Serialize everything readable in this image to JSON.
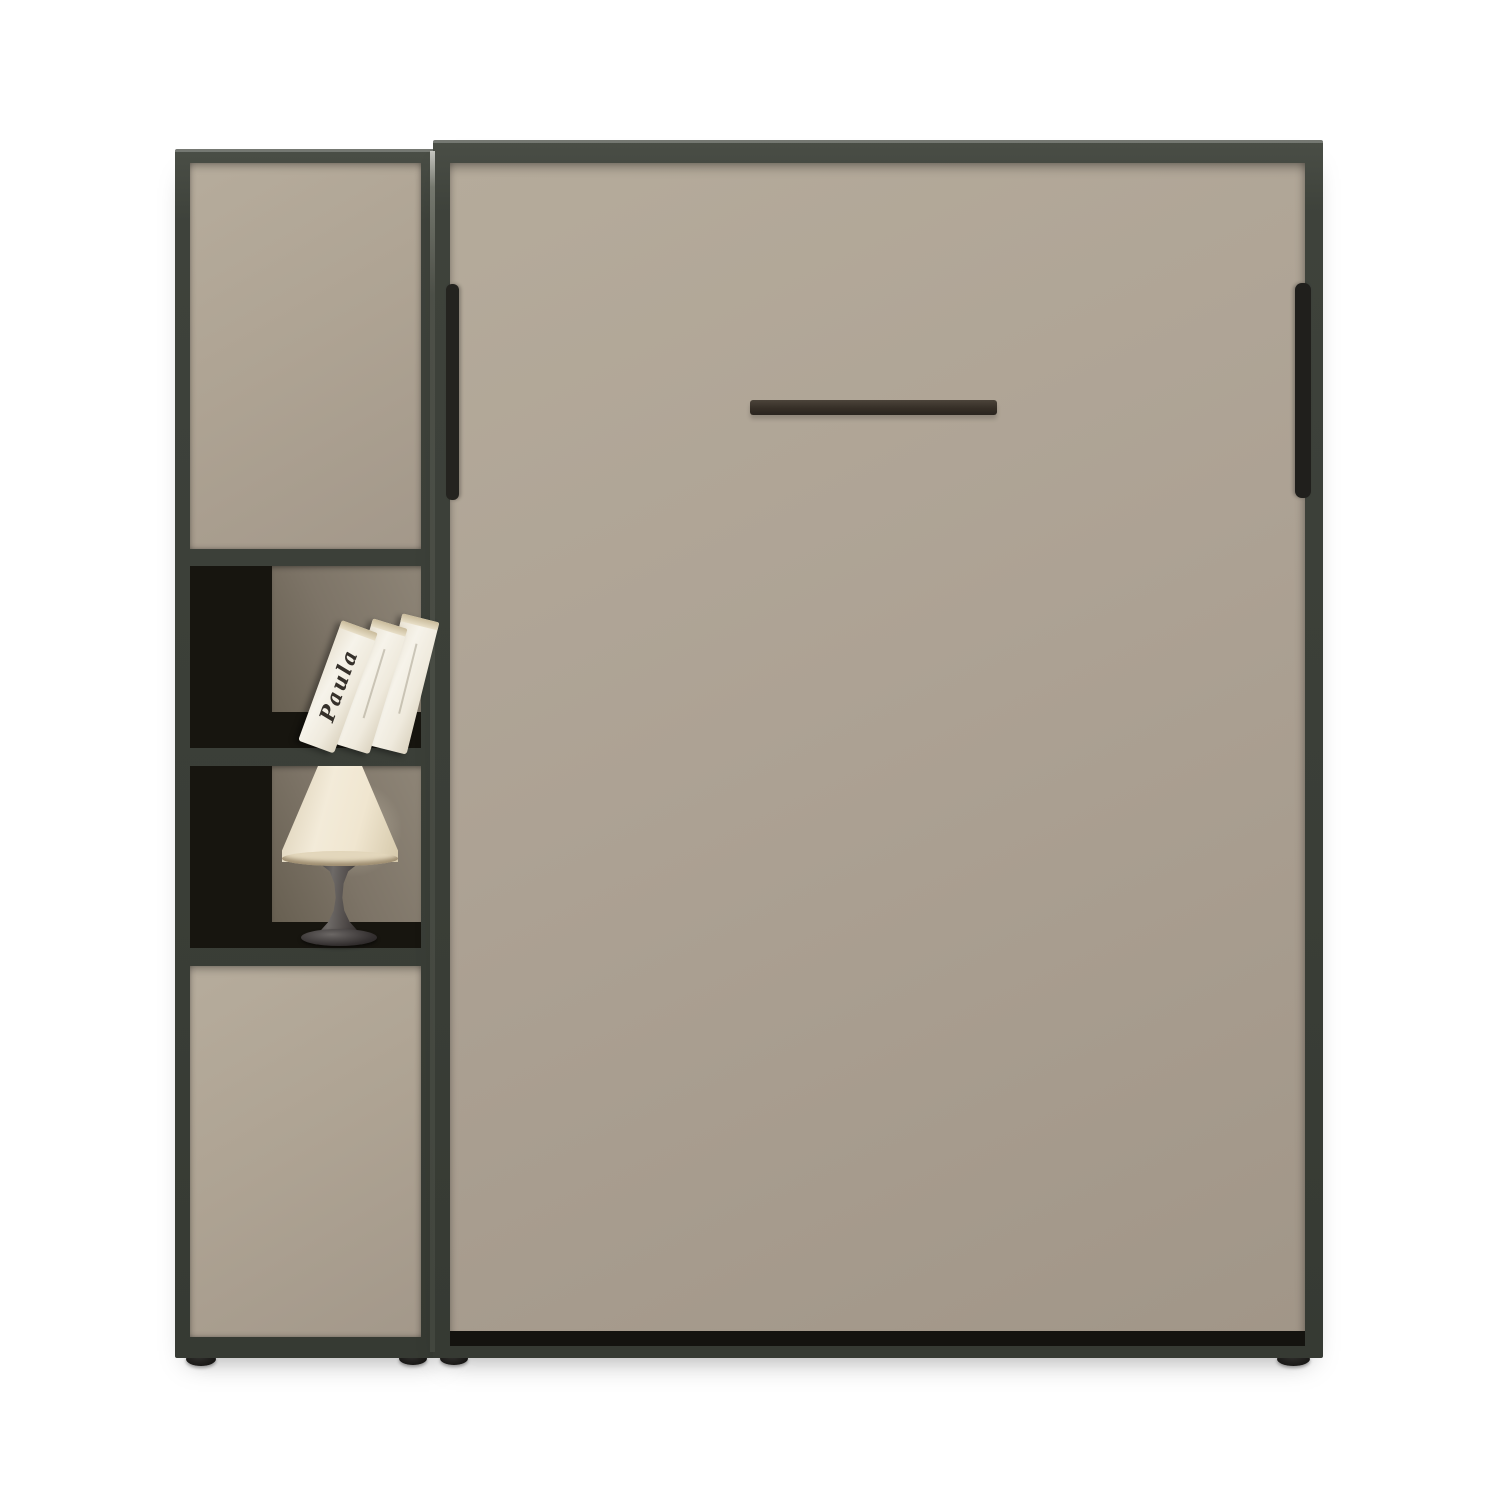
{
  "scene": {
    "subject": "vertical wall bed with side shelf cabinet, three books and a table lamp",
    "background_color": "#ffffff"
  },
  "palette": {
    "frame_dark": "#3e423b",
    "panel_beige": "#ada294",
    "niche_back_taupe": "#7d7467",
    "niche_shadow_black": "#17150f",
    "handle_dark": "#362f27",
    "book_white": "#f1ede1",
    "lamp_shade_cream": "#efe5d0",
    "lamp_base_gray": "#44403e",
    "feet_black": "#1d1c1a"
  },
  "furniture": {
    "bed": {
      "part": "wall-bed-front",
      "handle_type": "horizontal-bar"
    },
    "cabinet": {
      "doors": 2,
      "open_shelves": 2,
      "book_stack": {
        "count": 3,
        "spine_text": "Paula"
      },
      "lamp": {
        "type": "table-lamp"
      }
    },
    "feet_count": 4
  }
}
